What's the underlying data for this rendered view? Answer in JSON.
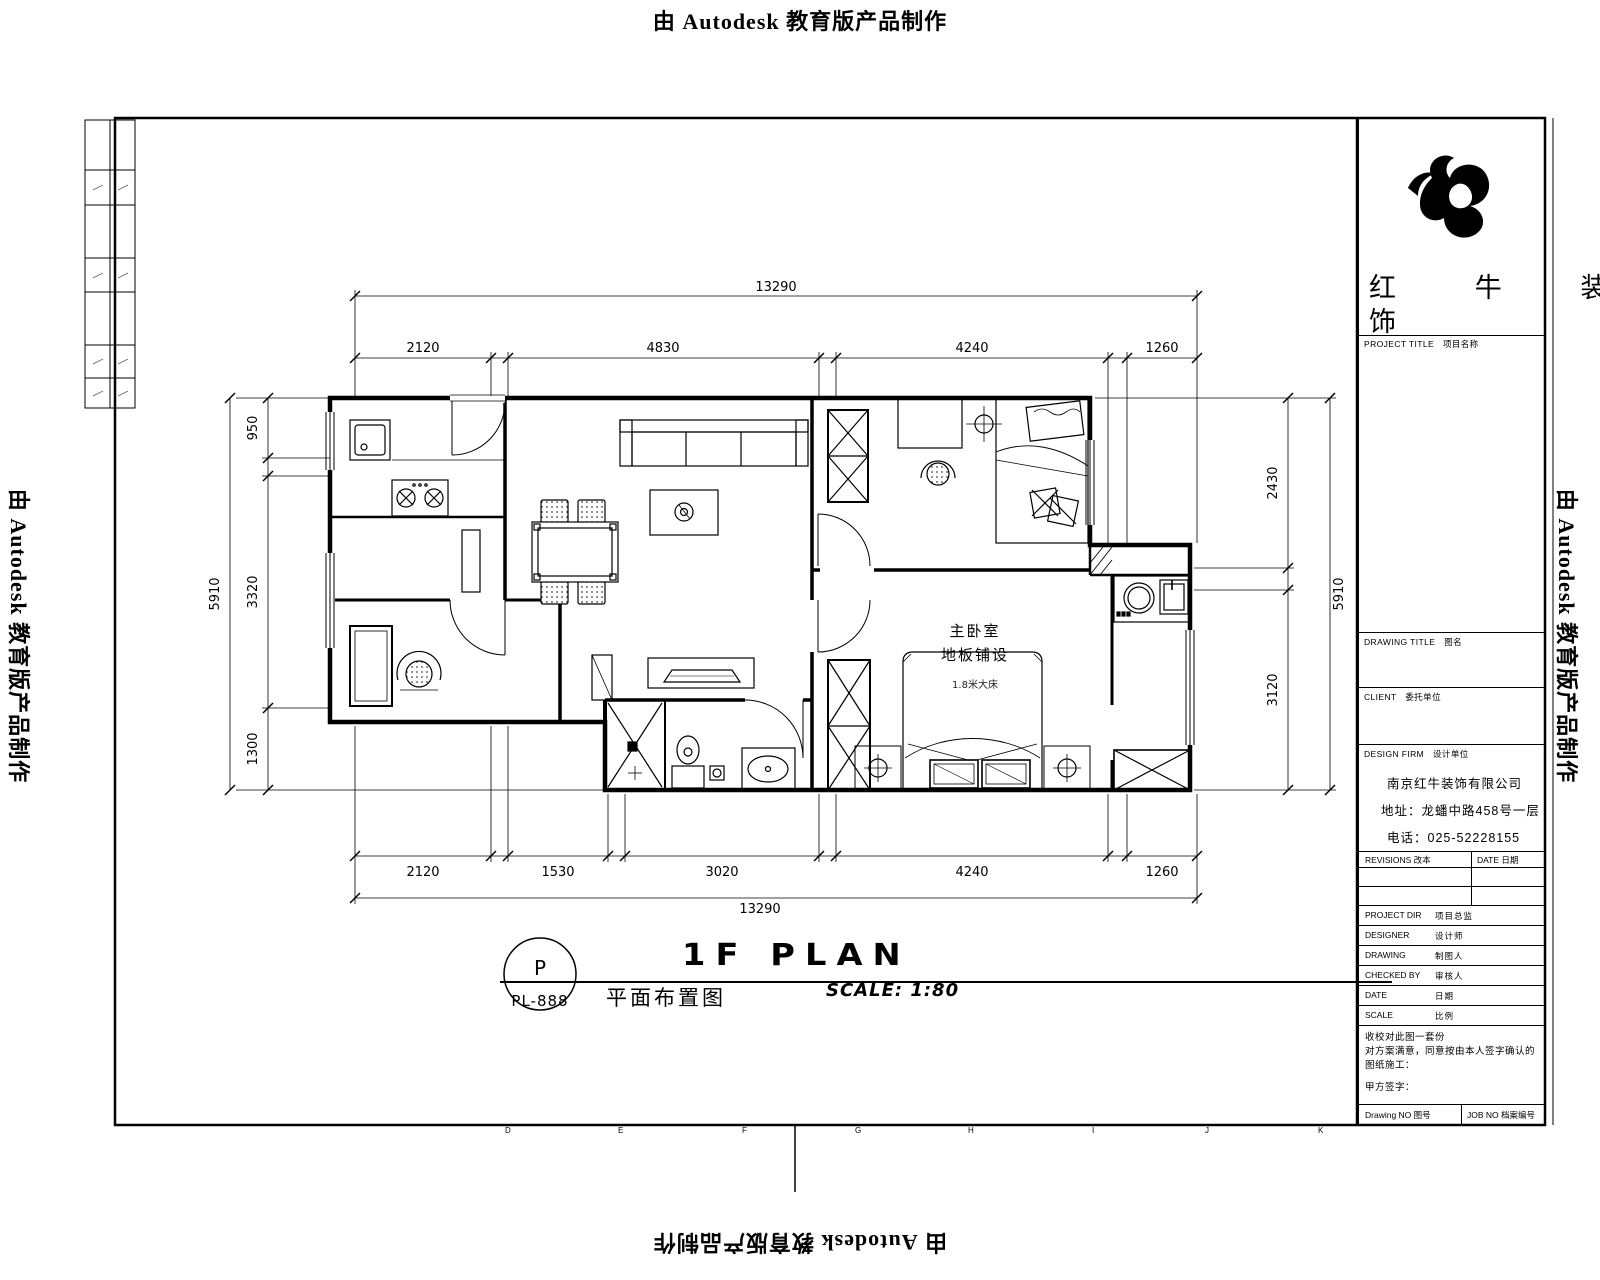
{
  "watermark": {
    "text": "由 Autodesk 教育版产品制作"
  },
  "sheet": {
    "grid_letters": [
      "D",
      "E",
      "F",
      "G",
      "H",
      "I",
      "J",
      "K"
    ]
  },
  "plan": {
    "labels": {
      "room_name": "主卧室",
      "room_floor": "地板铺设",
      "room_bed": "1.8米大床"
    },
    "dims": {
      "top_total": "13290",
      "top": [
        "2120",
        "4830",
        "4240",
        "1260"
      ],
      "bottom": [
        "2120",
        "1530",
        "3020",
        "4240",
        "1260"
      ],
      "bottom_total": "13290",
      "left": [
        "950",
        "3320",
        "1300"
      ],
      "left_total": "5910",
      "right": [
        "2430",
        "3120"
      ],
      "right_total": "5910"
    }
  },
  "title_bar": {
    "bubble_top": "P",
    "bubble_bottom": "PL-888",
    "cn_title": "平面布置图",
    "main_title": "1F PLAN",
    "scale": "SCALE: 1:80"
  },
  "title_block": {
    "logo_line1": "红 牛 装",
    "logo_line2": "饰",
    "project_title": "PROJECT TITLE　项目名称",
    "drawing_title": "DRAWING TITLE　图名",
    "client": "CLIENT　委托单位",
    "design_firm": "DESIGN FIRM　设计单位",
    "company": [
      "南京红牛装饰有限公司",
      "地址：龙蟠中路458号一层",
      "电话：025-52228155"
    ],
    "revisions": "REVISIONS 改本",
    "date_col": "DATE 日期",
    "rows": [
      {
        "label": "PROJECT DIR",
        "value": "项目总监"
      },
      {
        "label": "DESIGNER",
        "value": "设计师"
      },
      {
        "label": "DRAWING",
        "value": "制图人"
      },
      {
        "label": "CHECKED BY",
        "value": "审核人"
      },
      {
        "label": "DATE",
        "value": "日期"
      },
      {
        "label": "SCALE",
        "value": "比例"
      }
    ],
    "notes": [
      "收校对此图一套份",
      "对方案满意，同意按由本人签字确认的图纸施工：",
      "甲方签字："
    ],
    "drawing_no": "Drawing NO 图号",
    "job_no": "JOB NO 档案编号"
  }
}
